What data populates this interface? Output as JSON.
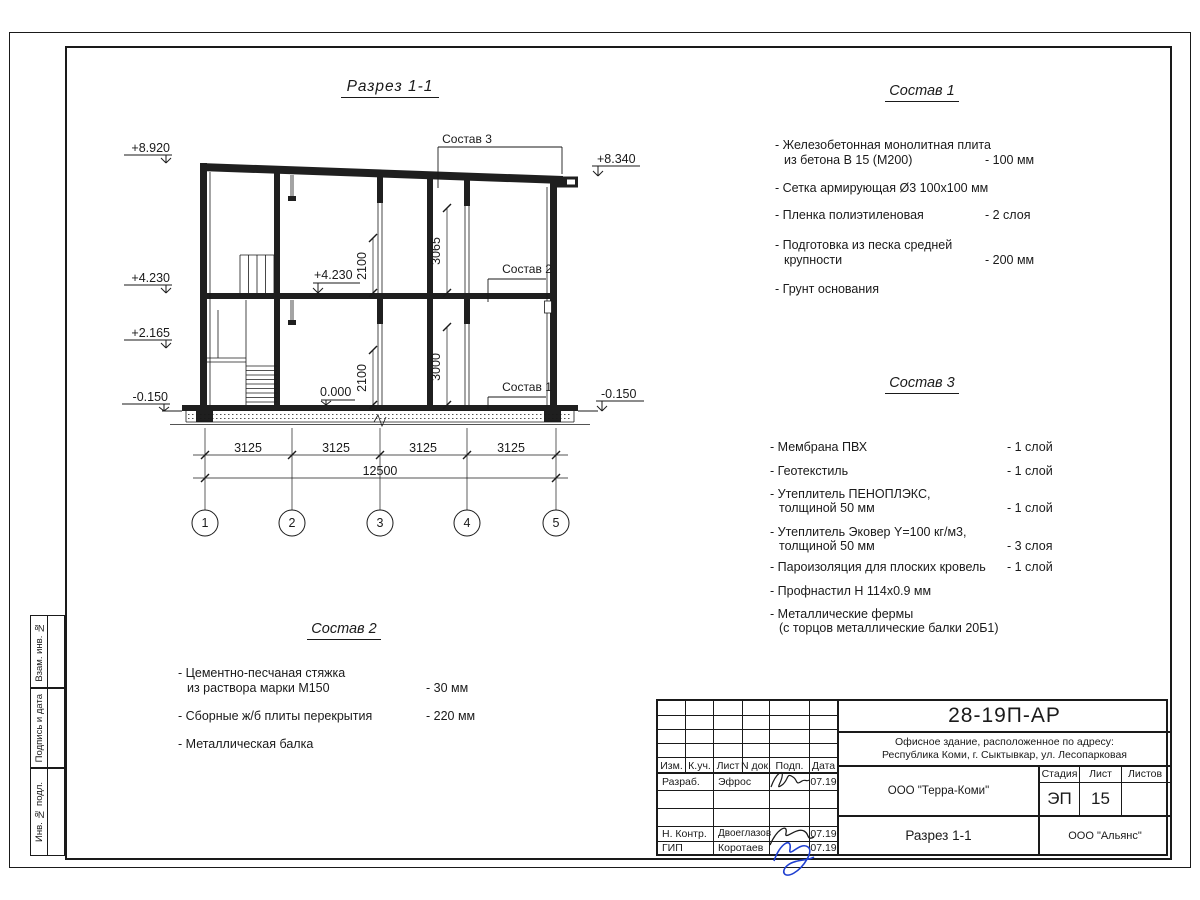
{
  "drawing": {
    "title": "Разрез 1-1",
    "elevations": {
      "roof_left": "+8.920",
      "floor2": "+4.230",
      "landing": "+2.165",
      "ground_left": "-0.150",
      "roof_right": "+8.340",
      "ground_right": "-0.150",
      "floor2_inner": "+4.230",
      "zero": "0.000"
    },
    "dims": {
      "bay": "3125",
      "total": "12500",
      "door": "2100",
      "h_upper": "3065",
      "h_lower": "3000"
    },
    "grid": [
      "1",
      "2",
      "3",
      "4",
      "5"
    ],
    "callout1": "Состав 1",
    "callout2": "Состав 2",
    "callout3": "Состав 3"
  },
  "sostav1": {
    "title": "Состав 1",
    "items": [
      {
        "lines": [
          "- Железобетонная  монолитная плита",
          "из бетона В 15 (М200)"
        ],
        "value": "- 100 мм"
      },
      {
        "lines": [
          "- Сетка армирующая Ø3 100х100 мм"
        ],
        "value": ""
      },
      {
        "lines": [
          "- Пленка полиэтиленовая"
        ],
        "value": "-  2 слоя"
      },
      {
        "lines": [
          "- Подготовка из песка средней",
          "крупности"
        ],
        "value": "- 200 мм"
      },
      {
        "lines": [
          "- Грунт основания"
        ],
        "value": ""
      }
    ]
  },
  "sostav2": {
    "title": "Состав 2",
    "items": [
      {
        "lines": [
          "- Цементно-песчаная стяжка",
          "из раствора марки М150"
        ],
        "value": "- 30 мм"
      },
      {
        "lines": [
          "- Сборные ж/б плиты перекрытия"
        ],
        "value": "- 220 мм"
      },
      {
        "lines": [
          "- Металлическая балка"
        ],
        "value": ""
      }
    ]
  },
  "sostav3": {
    "title": "Состав 3",
    "items": [
      {
        "lines": [
          "- Мембрана ПВХ"
        ],
        "value": "- 1 слой"
      },
      {
        "lines": [
          "- Геотекстиль"
        ],
        "value": "- 1 слой"
      },
      {
        "lines": [
          "- Утеплитель ПЕНОПЛЭКС,",
          "толщиной 50 мм"
        ],
        "value": "- 1 слой"
      },
      {
        "lines": [
          "- Утеплитель Эковер Y=100 кг/м3,",
          "толщиной 50 мм"
        ],
        "value": "- 3 слоя"
      },
      {
        "lines": [
          "- Пароизоляция для плоских кровель"
        ],
        "value": "- 1 слой"
      },
      {
        "lines": [
          "- Профнастил Н 114х0.9 мм"
        ],
        "value": ""
      },
      {
        "lines": [
          "- Металлические фермы",
          "(с торцов металлические балки 20Б1)"
        ],
        "value": ""
      }
    ]
  },
  "titleblock": {
    "doc_code": "28-19П-АР",
    "address_line1": "Офисное здание, расположенное по адресу:",
    "address_line2": "Республика Коми, г. Сыктывкар, ул. Лесопарковая",
    "header": {
      "izm": "Изм.",
      "kuch": "К.уч.",
      "list": "Лист",
      "ndok": "N док.",
      "podp": "Подп.",
      "data": "Дата"
    },
    "row_developer": {
      "role": "Разраб.",
      "name": "Эфрос",
      "date": "07.19"
    },
    "row_ncontrol": {
      "role": "Н. Контр.",
      "name": "Двоеглазов",
      "date": "07.19"
    },
    "row_gip": {
      "role": "ГИП",
      "name": "Коротаев",
      "date": "07.19"
    },
    "org_customer": "ООО \"Терра-Коми\"",
    "stage_label": "Стадия",
    "sheet_label": "Лист",
    "sheets_label": "Листов",
    "stage": "ЭП",
    "sheet_no": "15",
    "sheets_total": "",
    "drawing_name": "Разрез 1-1",
    "org_contractor": "ООО \"Альянс\""
  },
  "side_labels": {
    "vzam": "Взам. инв. №",
    "podpis": "Подпись и дата",
    "inv": "Инв. № подл."
  },
  "colors": {
    "ink": "#1a1a1a",
    "signature_blue": "#1f3fd0"
  }
}
